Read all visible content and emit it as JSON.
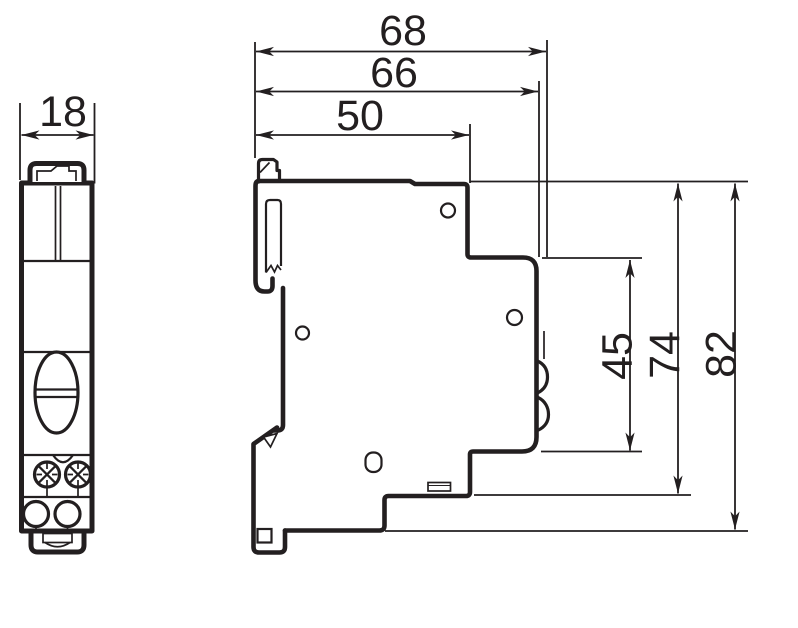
{
  "drawing": {
    "front_view": {
      "width": "18"
    },
    "side_view": {
      "depth_overall": "68",
      "depth_body": "66",
      "depth_upper": "50",
      "height_front": "45",
      "height_step": "74",
      "height_overall": "82"
    },
    "colors": {
      "line": "#231f20",
      "background": "#ffffff"
    }
  }
}
